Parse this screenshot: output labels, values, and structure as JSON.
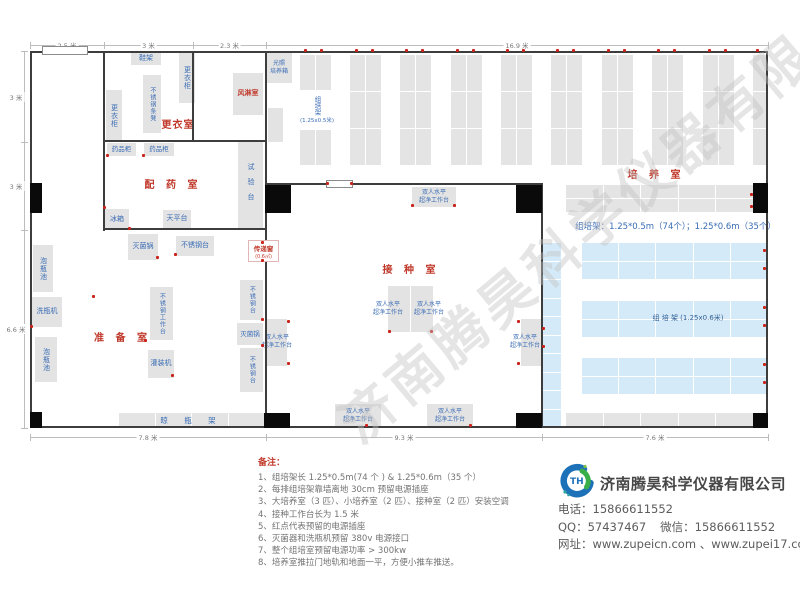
{
  "watermark": "济南腾昊科学仪器有限公司",
  "plan": {
    "rooms": [
      {
        "id": "room-label-changing",
        "label": "更衣室",
        "x": 156,
        "y": 116,
        "w": 44,
        "ls": 1
      },
      {
        "id": "room-label-dispensing",
        "label": "配 药 室",
        "x": 138,
        "y": 176,
        "w": 70,
        "ls": 4
      },
      {
        "id": "room-label-preparation",
        "label": "准 备 室",
        "x": 85,
        "y": 329,
        "w": 75,
        "ls": 4
      },
      {
        "id": "room-label-inoculation",
        "label": "接 种 室",
        "x": 375,
        "y": 261,
        "w": 72,
        "ls": 4
      },
      {
        "id": "room-label-culture",
        "label": "培 养 室",
        "x": 620,
        "y": 166,
        "w": 72,
        "ls": 4
      }
    ],
    "walls": [
      [
        30,
        51,
        738,
        2
      ],
      [
        30,
        426,
        738,
        2
      ],
      [
        30,
        51,
        2,
        377
      ],
      [
        766,
        51,
        2,
        377
      ],
      [
        103,
        51,
        2,
        180
      ],
      [
        192,
        51,
        2,
        91
      ],
      [
        104,
        140,
        162,
        2
      ],
      [
        265,
        51,
        2,
        377
      ],
      [
        104,
        228,
        162,
        2
      ],
      [
        266,
        183,
        277,
        2
      ],
      [
        541,
        184,
        2,
        244
      ]
    ],
    "columns": [
      [
        30,
        183,
        12,
        30
      ],
      [
        265,
        185,
        26,
        28
      ],
      [
        516,
        185,
        26,
        28
      ],
      [
        753,
        183,
        15,
        30
      ],
      [
        30,
        412,
        12,
        16
      ],
      [
        264,
        413,
        26,
        15
      ],
      [
        516,
        413,
        26,
        15
      ],
      [
        753,
        413,
        15,
        15
      ]
    ],
    "doors": [
      [
        42,
        46,
        46,
        9
      ],
      [
        326,
        180,
        27,
        8
      ]
    ],
    "racks": [
      {
        "x": 300,
        "y": 55,
        "w": 31,
        "h": 110,
        "cols": 2,
        "rows": 3,
        "c": "gray"
      },
      {
        "x": 350,
        "y": 55,
        "w": 31,
        "h": 110,
        "cols": 2,
        "rows": 3,
        "c": "gray"
      },
      {
        "x": 400,
        "y": 55,
        "w": 31,
        "h": 110,
        "cols": 2,
        "rows": 3,
        "c": "gray"
      },
      {
        "x": 451,
        "y": 55,
        "w": 31,
        "h": 110,
        "cols": 2,
        "rows": 3,
        "c": "gray"
      },
      {
        "x": 501,
        "y": 55,
        "w": 31,
        "h": 110,
        "cols": 2,
        "rows": 3,
        "c": "gray"
      },
      {
        "x": 551,
        "y": 55,
        "w": 31,
        "h": 110,
        "cols": 2,
        "rows": 3,
        "c": "gray"
      },
      {
        "x": 602,
        "y": 55,
        "w": 31,
        "h": 110,
        "cols": 2,
        "rows": 3,
        "c": "gray"
      },
      {
        "x": 652,
        "y": 55,
        "w": 31,
        "h": 110,
        "cols": 2,
        "rows": 3,
        "c": "gray"
      },
      {
        "x": 703,
        "y": 55,
        "w": 31,
        "h": 110,
        "cols": 2,
        "rows": 3,
        "c": "gray"
      },
      {
        "x": 753,
        "y": 55,
        "w": 14,
        "h": 110,
        "cols": 1,
        "rows": 3,
        "c": "gray"
      },
      {
        "x": 566,
        "y": 185,
        "w": 187,
        "h": 27,
        "cols": 5,
        "rows": 2,
        "c": "gray"
      },
      {
        "x": 566,
        "y": 413,
        "w": 187,
        "h": 14,
        "cols": 5,
        "rows": 1,
        "c": "gray"
      },
      {
        "x": 541,
        "y": 243,
        "w": 20,
        "h": 184,
        "cols": 1,
        "rows": 10,
        "c": "blue"
      },
      {
        "x": 582,
        "y": 243,
        "w": 185,
        "h": 36,
        "cols": 5,
        "rows": 2,
        "c": "blue"
      },
      {
        "x": 582,
        "y": 301,
        "w": 185,
        "h": 36,
        "cols": 5,
        "rows": 2,
        "c": "blue"
      },
      {
        "x": 582,
        "y": 358,
        "w": 185,
        "h": 36,
        "cols": 5,
        "rows": 2,
        "c": "blue"
      },
      {
        "x": 119,
        "y": 413,
        "w": 145,
        "h": 14,
        "cols": 4,
        "rows": 1,
        "c": "gray",
        "label": "晾 瓶 架"
      }
    ],
    "equipment": [
      {
        "id": "shoe-rack",
        "label": "鞋架",
        "x": 131,
        "y": 53,
        "w": 30,
        "h": 12
      },
      {
        "id": "locker",
        "label": "更衣柜",
        "x": 179,
        "y": 53,
        "w": 16,
        "h": 50,
        "dir": "v"
      },
      {
        "id": "stainless-bench",
        "label": "不锈钢条凳",
        "x": 143,
        "y": 75,
        "w": 18,
        "h": 58,
        "dir": "v",
        "fs": 6
      },
      {
        "id": "locker",
        "label": "更衣柜",
        "x": 106,
        "y": 90,
        "w": 16,
        "h": 52,
        "dir": "v"
      },
      {
        "id": "air-shower",
        "label": "风淋室",
        "x": 233,
        "y": 73,
        "w": 30,
        "h": 42,
        "red": true
      },
      {
        "id": "light-incubator",
        "label": "光照\n培养箱",
        "x": 266,
        "y": 53,
        "w": 26,
        "h": 30,
        "fs": 6
      },
      {
        "id": "gray-box",
        "label": "",
        "x": 268,
        "y": 108,
        "w": 15,
        "h": 34
      },
      {
        "id": "medicine-cabinet",
        "label": "药品柜",
        "x": 107,
        "y": 143,
        "w": 29,
        "h": 13,
        "fs": 6.5
      },
      {
        "id": "medicine-cabinet",
        "label": "药品柜",
        "x": 144,
        "y": 143,
        "w": 30,
        "h": 13,
        "fs": 6.5
      },
      {
        "id": "test-bench",
        "label": "试验台",
        "x": 238,
        "y": 140,
        "w": 25,
        "h": 90,
        "dir": "v",
        "sp": true
      },
      {
        "id": "fridge",
        "label": "冰箱",
        "x": 105,
        "y": 209,
        "w": 24,
        "h": 21
      },
      {
        "id": "balance-table",
        "label": "天平台",
        "x": 163,
        "y": 210,
        "w": 28,
        "h": 18
      },
      {
        "id": "sterilizer-pot",
        "label": "灭菌锅",
        "x": 128,
        "y": 234,
        "w": 30,
        "h": 26
      },
      {
        "id": "stainless-table",
        "label": "不锈钢台",
        "x": 176,
        "y": 236,
        "w": 38,
        "h": 20
      },
      {
        "id": "bottle-soak-pool",
        "label": "泡瓶池",
        "x": 33,
        "y": 245,
        "w": 20,
        "h": 47,
        "dir": "v"
      },
      {
        "id": "bottle-washer",
        "label": "洗瓶机",
        "x": 32,
        "y": 297,
        "w": 30,
        "h": 30
      },
      {
        "id": "bottle-soak-pool",
        "label": "泡瓶池",
        "x": 35,
        "y": 337,
        "w": 22,
        "h": 45,
        "dir": "v"
      },
      {
        "id": "stainless-worktable",
        "label": "不锈钢工作台",
        "x": 150,
        "y": 287,
        "w": 23,
        "h": 53,
        "dir": "v",
        "fs": 6
      },
      {
        "id": "filling-machine",
        "label": "灌装机",
        "x": 148,
        "y": 350,
        "w": 26,
        "h": 28
      },
      {
        "id": "stainless-table",
        "label": "不锈钢台",
        "x": 240,
        "y": 280,
        "w": 23,
        "h": 40,
        "dir": "v",
        "fs": 6
      },
      {
        "id": "sterilizer-pot",
        "label": "灭菌锅",
        "x": 237,
        "y": 323,
        "w": 26,
        "h": 22,
        "fs": 6.5
      },
      {
        "id": "stainless-table",
        "label": "不锈钢台",
        "x": 240,
        "y": 348,
        "w": 23,
        "h": 44,
        "dir": "v",
        "fs": 6
      },
      {
        "id": "clean-bench",
        "label": "双人水平\n超净工作台",
        "x": 412,
        "y": 187,
        "w": 44,
        "h": 20,
        "fs": 6
      },
      {
        "id": "clean-bench",
        "label": "",
        "x": 388,
        "y": 286,
        "w": 22,
        "h": 46
      },
      {
        "id": "clean-bench",
        "label": "",
        "x": 411,
        "y": 286,
        "w": 22,
        "h": 46
      },
      {
        "id": "clean-bench-label",
        "label": "双人水平\n超净工作台",
        "x": 371,
        "y": 300,
        "w": 34,
        "h": 18,
        "fs": 6,
        "noBg": true
      },
      {
        "id": "clean-bench-label",
        "label": "双人水平\n超净工作台",
        "x": 412,
        "y": 300,
        "w": 34,
        "h": 18,
        "fs": 6,
        "noBg": true
      },
      {
        "id": "clean-bench",
        "label": "",
        "x": 266,
        "y": 319,
        "w": 21,
        "h": 47
      },
      {
        "id": "clean-bench-label",
        "label": "双人水平\n超净工作台",
        "x": 259,
        "y": 333,
        "w": 36,
        "h": 18,
        "fs": 6,
        "noBg": true
      },
      {
        "id": "clean-bench",
        "label": "",
        "x": 521,
        "y": 319,
        "w": 21,
        "h": 47
      },
      {
        "id": "clean-bench-label",
        "label": "双人水平\n超净工作台",
        "x": 507,
        "y": 333,
        "w": 36,
        "h": 18,
        "fs": 6,
        "noBg": true
      },
      {
        "id": "clean-bench",
        "label": "双人水平\n超净工作台",
        "x": 335,
        "y": 404,
        "w": 46,
        "h": 23,
        "fs": 6
      },
      {
        "id": "clean-bench",
        "label": "双人水平\n超净工作台",
        "x": 427,
        "y": 404,
        "w": 46,
        "h": 23,
        "fs": 6
      }
    ],
    "rack_note1_v": "组培架",
    "rack_note1_h": "(1.25x0.5米)",
    "rack_note2": "组  培  架 (1.25x0.6米)",
    "rack_spec": "组培架：1.25*0.5m（74个）；1.25*0.6m（35个）",
    "pass_window": {
      "label": "传递窗",
      "sub": "(0.6㎡)",
      "x": 248,
      "y": 240,
      "w": 31,
      "h": 22
    },
    "outlets": [
      [
        305,
        50
      ],
      [
        321,
        50
      ],
      [
        356,
        50
      ],
      [
        372,
        50
      ],
      [
        406,
        50
      ],
      [
        422,
        50
      ],
      [
        457,
        50
      ],
      [
        473,
        50
      ],
      [
        507,
        50
      ],
      [
        523,
        50
      ],
      [
        557,
        50
      ],
      [
        573,
        50
      ],
      [
        608,
        50
      ],
      [
        624,
        50
      ],
      [
        658,
        50
      ],
      [
        674,
        50
      ],
      [
        709,
        50
      ],
      [
        725,
        50
      ],
      [
        757,
        50
      ],
      [
        764,
        250
      ],
      [
        764,
        268
      ],
      [
        764,
        307
      ],
      [
        764,
        325
      ],
      [
        764,
        364
      ],
      [
        764,
        382
      ],
      [
        751,
        194
      ],
      [
        751,
        206
      ],
      [
        543,
        328
      ],
      [
        543,
        346
      ],
      [
        412,
        205
      ],
      [
        454,
        205
      ],
      [
        327,
        183
      ],
      [
        351,
        183
      ],
      [
        389,
        331
      ],
      [
        431,
        331
      ],
      [
        366,
        425
      ],
      [
        470,
        425
      ],
      [
        288,
        321
      ],
      [
        288,
        363
      ],
      [
        518,
        321
      ],
      [
        518,
        363
      ],
      [
        129,
        228
      ],
      [
        104,
        207
      ],
      [
        157,
        257
      ],
      [
        175,
        254
      ],
      [
        262,
        242
      ],
      [
        262,
        260
      ],
      [
        93,
        296
      ],
      [
        31,
        326
      ],
      [
        145,
        340
      ],
      [
        172,
        375
      ],
      [
        262,
        319
      ],
      [
        262,
        345
      ],
      [
        107,
        155
      ],
      [
        143,
        155
      ]
    ],
    "dims": {
      "top": {
        "o": "h",
        "pos": 45,
        "segs": [
          {
            "label": "2.5 米",
            "from": 30,
            "to": 104
          },
          {
            "label": "3 米",
            "from": 104,
            "to": 193
          },
          {
            "label": "2.3 米",
            "from": 193,
            "to": 266
          },
          {
            "label": "16.9 米",
            "from": 266,
            "to": 768
          }
        ]
      },
      "left": {
        "o": "v",
        "pos": 24,
        "segs": [
          {
            "label": "3 米",
            "from": 51,
            "to": 142
          },
          {
            "label": "3 米",
            "from": 142,
            "to": 230
          },
          {
            "label": "6.6 米",
            "from": 230,
            "to": 428
          }
        ]
      },
      "bottom": {
        "o": "h",
        "pos": 437,
        "segs": [
          {
            "label": "7.8 米",
            "from": 30,
            "to": 266
          },
          {
            "label": "9.3 米",
            "from": 266,
            "to": 542
          },
          {
            "label": "7.6 米",
            "from": 542,
            "to": 768
          }
        ]
      }
    }
  },
  "notes": {
    "title": "备注：",
    "items": [
      "1、组培架长 1.25*0.5m(74 个 ) & 1.25*0.6m（35 个）",
      "2、每排组培架靠墙离地 30cm 预留电源插座",
      "3、大培养室（3 匹）、小培养室（2 匹）、接种室（2 匹）安装空调",
      "4、接种工作台长为 1.5 米",
      "5、红点代表预留的电源插座",
      "6、灭菌器和洗瓶机预留 380v 电源接口",
      "7、整个组培室预留电源功率 > 300kw",
      "8、培养室推拉门地轨和地面一平，方便小推车推送。"
    ]
  },
  "company": {
    "name": "济南腾昊科学仪器有限公司",
    "logo_text": "TH",
    "phone_label": "电话：",
    "phone": "15866611552",
    "qq_label": "QQ：",
    "qq": "57437467",
    "wechat_label": "微信：",
    "wechat": "15866611552",
    "web_label": "网址：",
    "web": "www.zupeicn.com 、www.zupei17.com"
  },
  "colors": {
    "room_label": "#c0392b",
    "equip_text": "#3a6cb4",
    "rack_gray": "#e4e4e4",
    "rack_blue": "#d5eaf8",
    "outlet_dot": "#c9231a",
    "wall": "#3d3d3d"
  }
}
